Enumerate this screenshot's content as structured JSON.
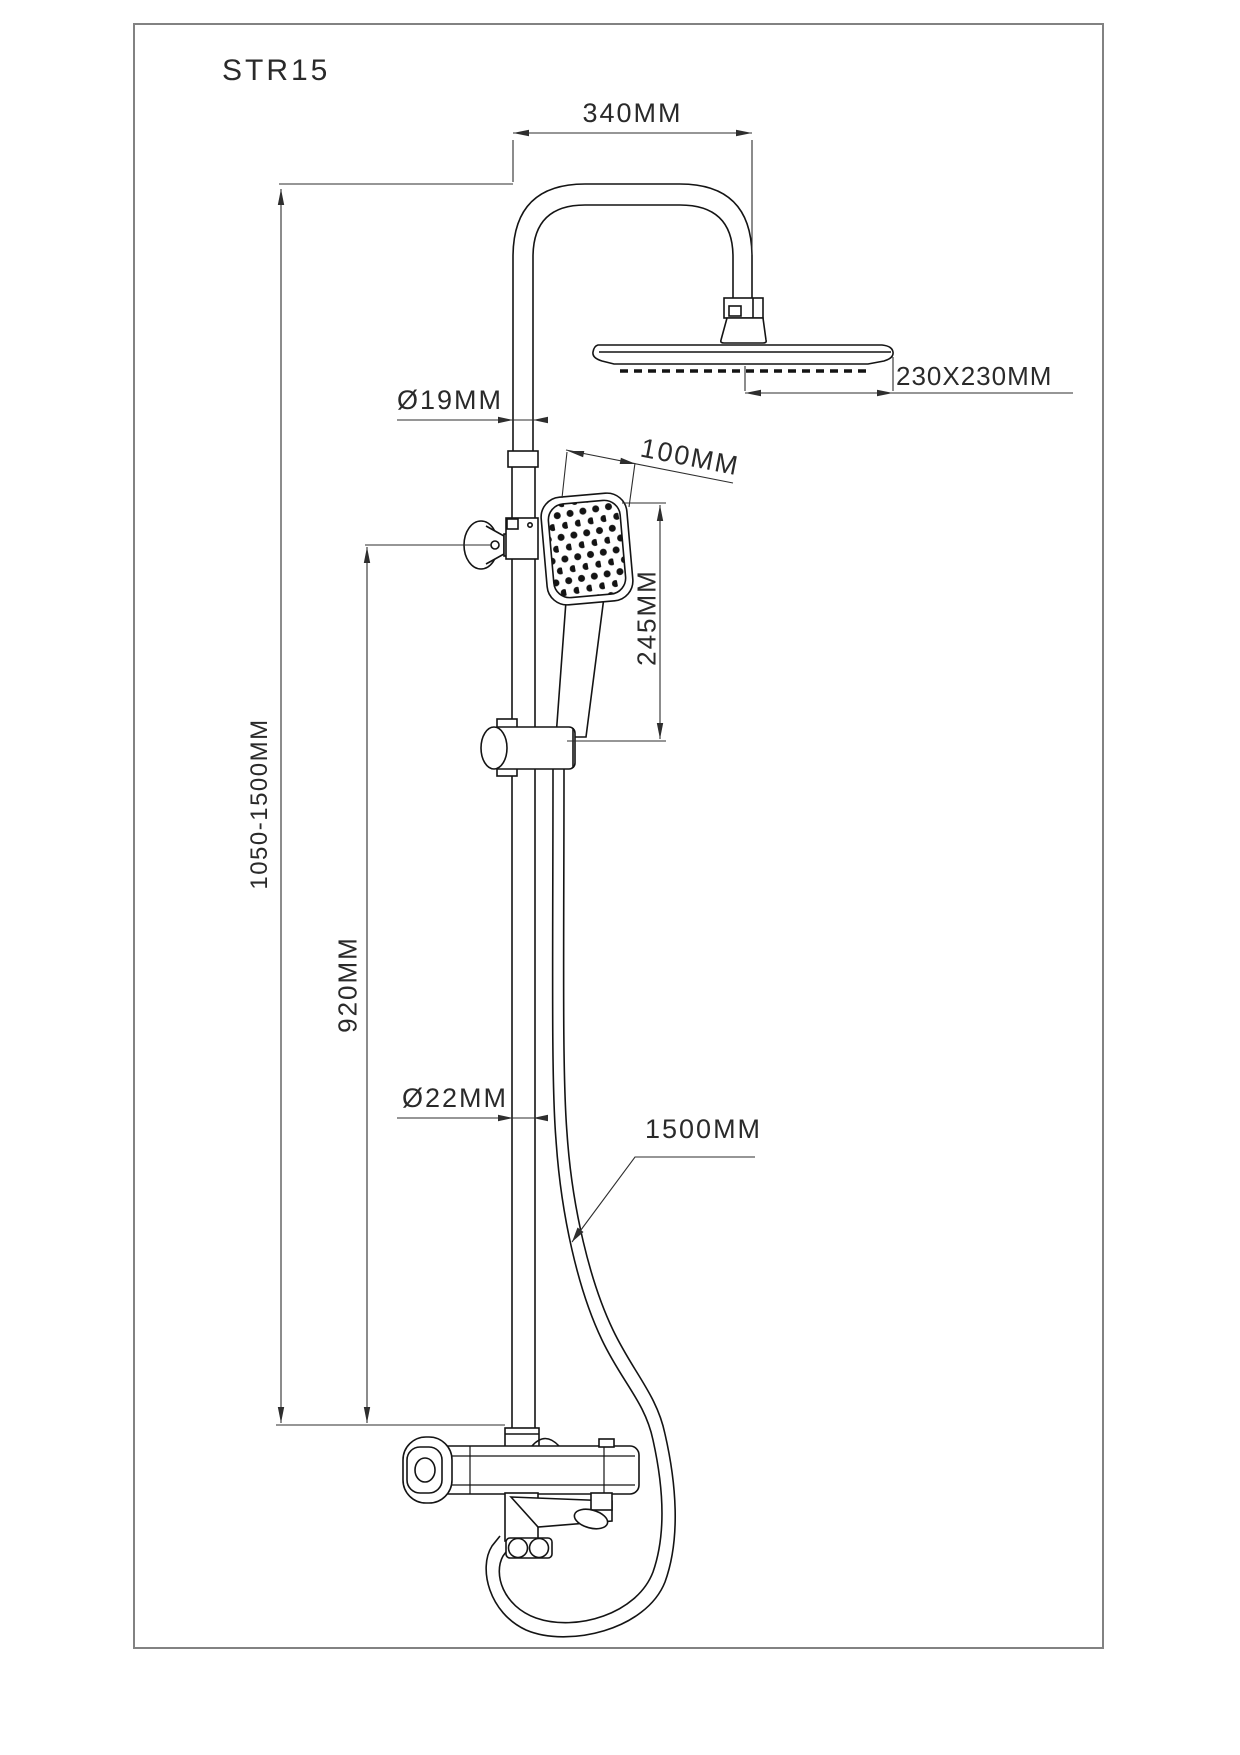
{
  "title": "STR15",
  "labels": {
    "top_width": "340MM",
    "overhead_size": "230X230MM",
    "upper_pipe_dia": "Ø19MM",
    "handshower_width": "100MM",
    "handshower_length": "245MM",
    "overall_height": "1050-1500MM",
    "rail_height": "920MM",
    "rail_dia": "Ø22MM",
    "hose_length": "1500MM"
  },
  "colors": {
    "object_line": "#141414",
    "dimension_line": "#2e2e2e",
    "frame_border": "#828282",
    "background": "#ffffff"
  }
}
